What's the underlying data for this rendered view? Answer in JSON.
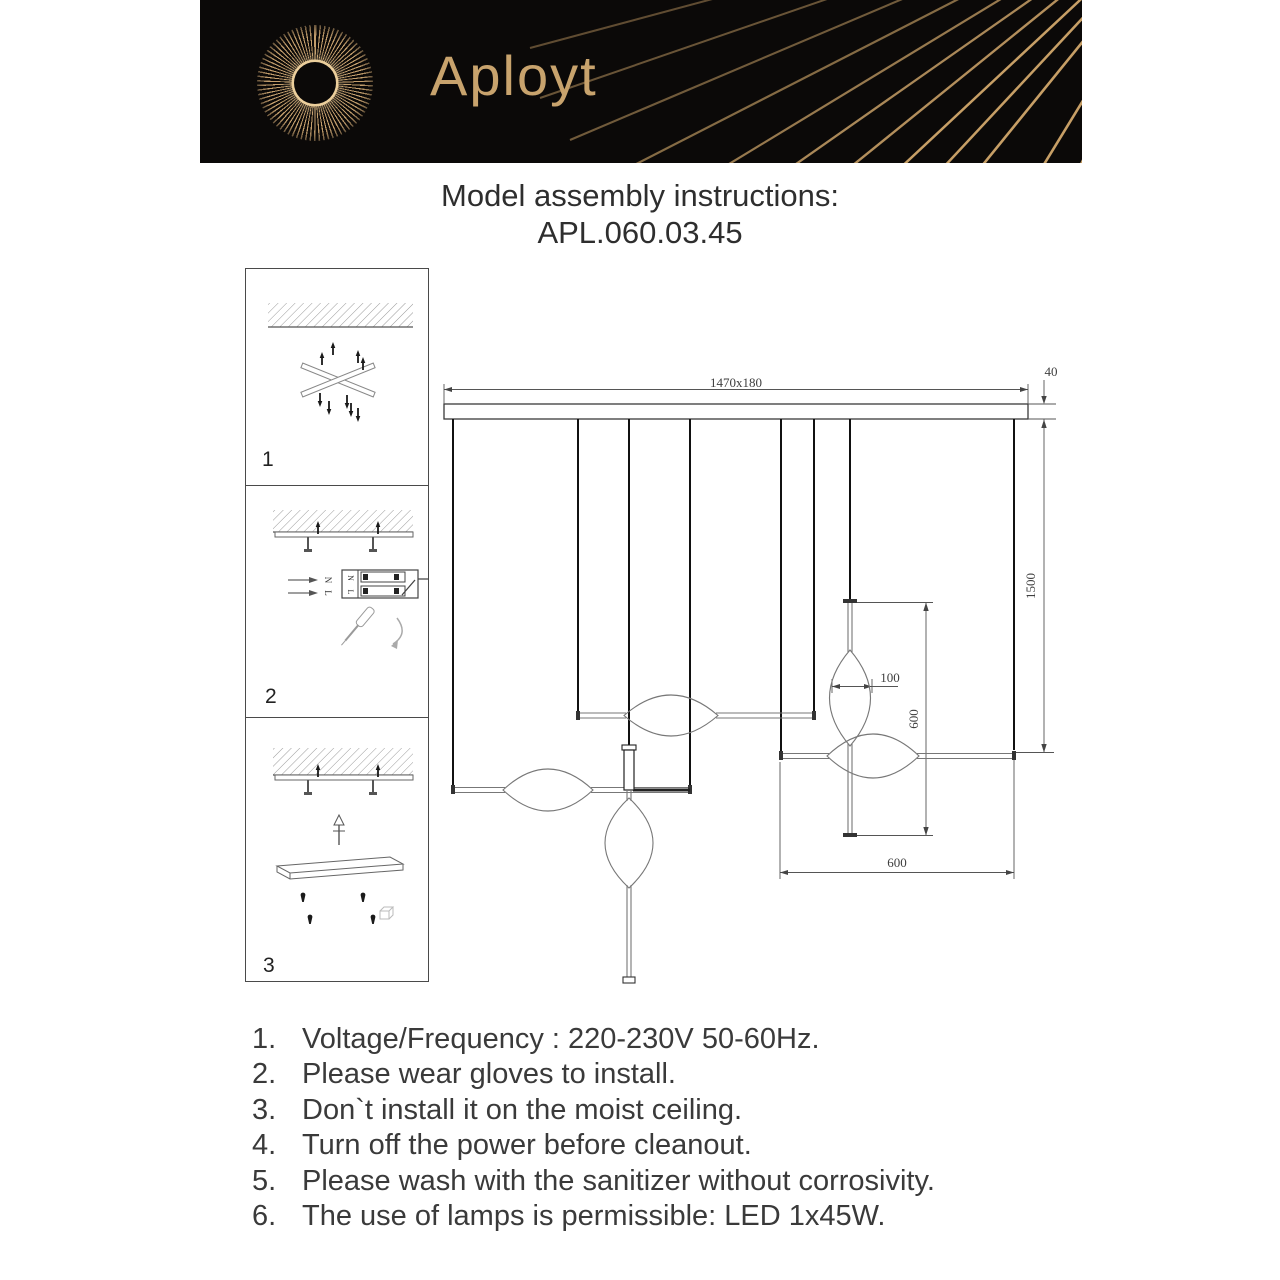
{
  "header": {
    "brand": "Aployt"
  },
  "title": {
    "heading": "Model assembly instructions:",
    "model": "APL.060.03.45"
  },
  "steps": {
    "step1": "1",
    "step2": "2",
    "step3": "3"
  },
  "wiring": {
    "wire_n": "N",
    "wire_l": "L",
    "terminal_n": "N",
    "terminal_l": "L"
  },
  "dimensions": {
    "canopy": "1470x180",
    "canopy_height": "40",
    "drop_height": "1500",
    "vertical_tube_length": "600",
    "lens_width": "100",
    "horizontal_tube_length": "600"
  },
  "instructions": [
    {
      "num": "1.",
      "text": "Voltage/Frequency : 220-230V 50-60Hz."
    },
    {
      "num": "2.",
      "text": "Please wear gloves to install."
    },
    {
      "num": "3.",
      "text": "Don`t install it on the moist ceiling."
    },
    {
      "num": "4.",
      "text": "Turn off the power before cleanout."
    },
    {
      "num": "5.",
      "text": "Please wash with the sanitizer without corrosivity."
    },
    {
      "num": "6.",
      "text": "The use of lamps is permissible: LED 1x45W."
    }
  ],
  "colors": {
    "header_bg": "#0b0908",
    "gold": "#c9a472",
    "text": "#2e2e2e",
    "drawing_line": "#444444"
  }
}
